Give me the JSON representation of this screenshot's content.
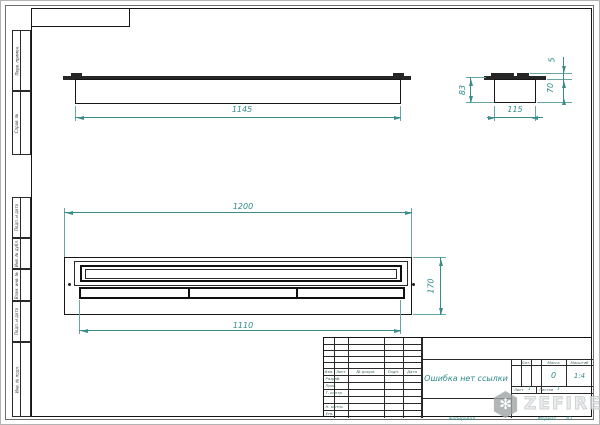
{
  "frame": {
    "margin_labels": [
      "Перв. примен.",
      "Справ. №",
      "Подп. и дата",
      "Инв. № дубл.",
      "Взам. инв. №",
      "Подп. и дата",
      "Инв. № подл."
    ],
    "kopiroval": "Копировал",
    "format_label": "Формат",
    "format_value": "A3"
  },
  "drawing": {
    "front_view": {
      "dim_length": "1145"
    },
    "side_view": {
      "dim_height": "83",
      "dim_tab": "5",
      "dim_body": "70",
      "dim_width": "115"
    },
    "plan_view": {
      "dim_overall": "1200",
      "dim_inner": "1110",
      "dim_depth": "170"
    }
  },
  "title_block": {
    "cols": [
      "Изм.",
      "Лист",
      "№ докум.",
      "Подп.",
      "Дата"
    ],
    "sign_rows": [
      "Разраб.",
      "Пров.",
      "Т. контр.",
      "",
      "Н. контр.",
      "Утв."
    ],
    "doc_title": "Ошибка нет ссылки",
    "lit_label": "Лит.",
    "mass_label": "Масса",
    "scale_label": "Масштаб",
    "mass_value": "0",
    "scale_value": "1:4",
    "sheet_label": "Лист",
    "sheet_value": "1",
    "sheets_label": "Листов",
    "sheets_value": "1"
  },
  "watermark": {
    "brand": "ZEFIRE"
  },
  "colors": {
    "dimension": "#3a8c8c",
    "line": "#1b1b1b",
    "watermark": "#c3c8c8"
  }
}
